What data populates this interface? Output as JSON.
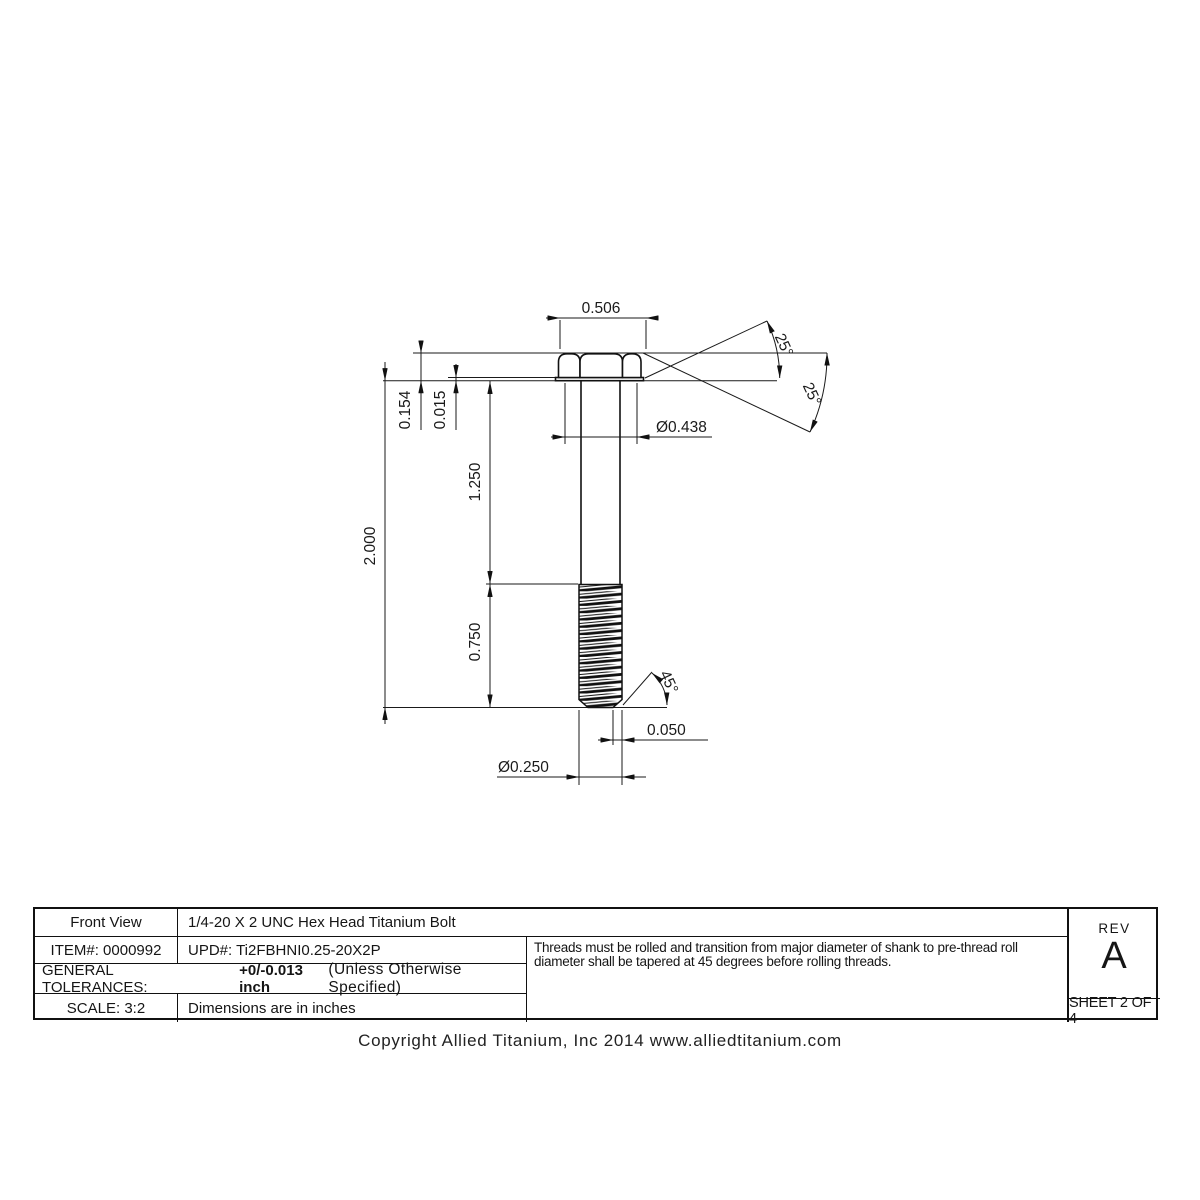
{
  "drawing": {
    "dimensions": {
      "head_across_corners": "0.506",
      "head_chamfer_angle_1": "25°",
      "head_chamfer_angle_2": "25°",
      "head_height": "0.154",
      "washer_face_thickness": "0.015",
      "head_across_flats_dia": "Ø0.438",
      "overall_length": "2.000",
      "grip_length": "1.250",
      "thread_length": "0.750",
      "point_chamfer_angle": "45°",
      "point_chamfer_length": "0.050",
      "shank_dia": "Ø0.250"
    }
  },
  "title_block": {
    "view_label": "Front View",
    "part_title": "1/4-20 X 2 UNC Hex Head Titanium Bolt",
    "item_label": "ITEM#: 0000992",
    "upd_label": "UPD#: Ti2FBHNI0.25-20X2P",
    "tolerances_label": "GENERAL TOLERANCES:",
    "tolerances_value": "+0/-0.013 inch",
    "tolerances_note": "(Unless Otherwise Specified)",
    "scale_label": "SCALE: 3:2",
    "units_note": "Dimensions are in inches",
    "notes": "Threads must be rolled and transition from major diameter of shank to pre-thread roll diameter shall be tapered at 45 degrees before rolling threads.",
    "rev_label": "REV",
    "rev_value": "A",
    "sheet_label": "SHEET 2 OF 4"
  },
  "footer": {
    "copyright": "Copyright Allied Titanium, Inc 2014 www.alliedtitanium.com"
  }
}
